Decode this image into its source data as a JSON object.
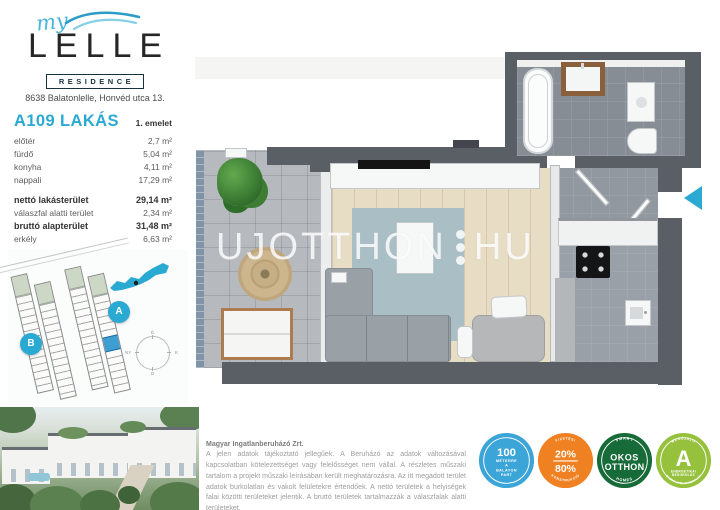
{
  "colors": {
    "accent_cyan": "#2aa9d2",
    "wall_gray": "#5a5f66",
    "wood_floor": "#e7dcc4",
    "tile_gray": "#9aa0a8",
    "badge_blue": "#3ba5d8",
    "badge_orange": "#f08123",
    "badge_dark_green": "#176b38",
    "badge_light_green": "#96c13d"
  },
  "logo": {
    "script": "my",
    "name": "LELLE",
    "tagline": "RESIDENCE"
  },
  "address": "8638 Balatonlelle, Honvéd utca 13.",
  "apartment": {
    "id": "A109 LAKÁS",
    "floor": "1. emelet",
    "rooms": [
      {
        "label": "előtér",
        "value": "2,7 m²"
      },
      {
        "label": "fürdő",
        "value": "5,04 m²"
      },
      {
        "label": "konyha",
        "value": "4,11 m²"
      },
      {
        "label": "nappali",
        "value": "17,29 m²"
      }
    ],
    "totals": [
      {
        "label": "nettó lakásterület",
        "value": "29,14 m²"
      },
      {
        "label": "válaszfal alatti terület",
        "value": "2,34 m²"
      },
      {
        "label": "bruttó alapterület",
        "value": "31,48 m²"
      },
      {
        "label": "erkély",
        "value": "6,63 m²"
      }
    ],
    "sale": {
      "label": "ÉRTÉKESÍTÉSI TERÜLET",
      "value": "34,795 m²"
    }
  },
  "siteplan": {
    "badge_a": "A",
    "badge_b": "B",
    "compass": {
      "n": "É",
      "e": "K",
      "s": "D",
      "w": "NY"
    }
  },
  "watermark": {
    "left": "UJOTTHON",
    "right": "HU"
  },
  "disclaimer": {
    "company": "Magyar Ingatlanberuházó Zrt.",
    "body": "A jelen adatok tájékoztató jellegűek. A Beruházó az adatok változásával kapcsolatban kötelezettséget vagy felelősséget nem vállal. A részletes műszaki tartalom a projekt műszaki leírásában került meghatározásra. Az itt megadott terület adatok burkolatlan és vakolt felületekre értendőek. A nettó területek a helyiségek falai közötti területeket jelentik. A bruttó területek tartalmazzák a válaszfalak alatti területeket."
  },
  "badges": {
    "distance": {
      "l1": "100",
      "l2": "MÉTERRE",
      "l3": "A",
      "l4": "BALATON",
      "l5": "PART"
    },
    "payment": {
      "top": "FIZETÉSI",
      "main": "20%",
      "sub": "80%",
      "bottom": "KONSTRUKCIÓ"
    },
    "smart": {
      "top": "SMART",
      "l1": "OKOS",
      "l2": "OTTHON",
      "bottom": "HOMES"
    },
    "energy": {
      "top": "MEGÚJULÓ",
      "letter": "A",
      "l1": "ENERGETIKAI",
      "l2": "BESOROLÁS",
      "bottom": "ENERGIAFELHASZNÁLÁS"
    }
  }
}
